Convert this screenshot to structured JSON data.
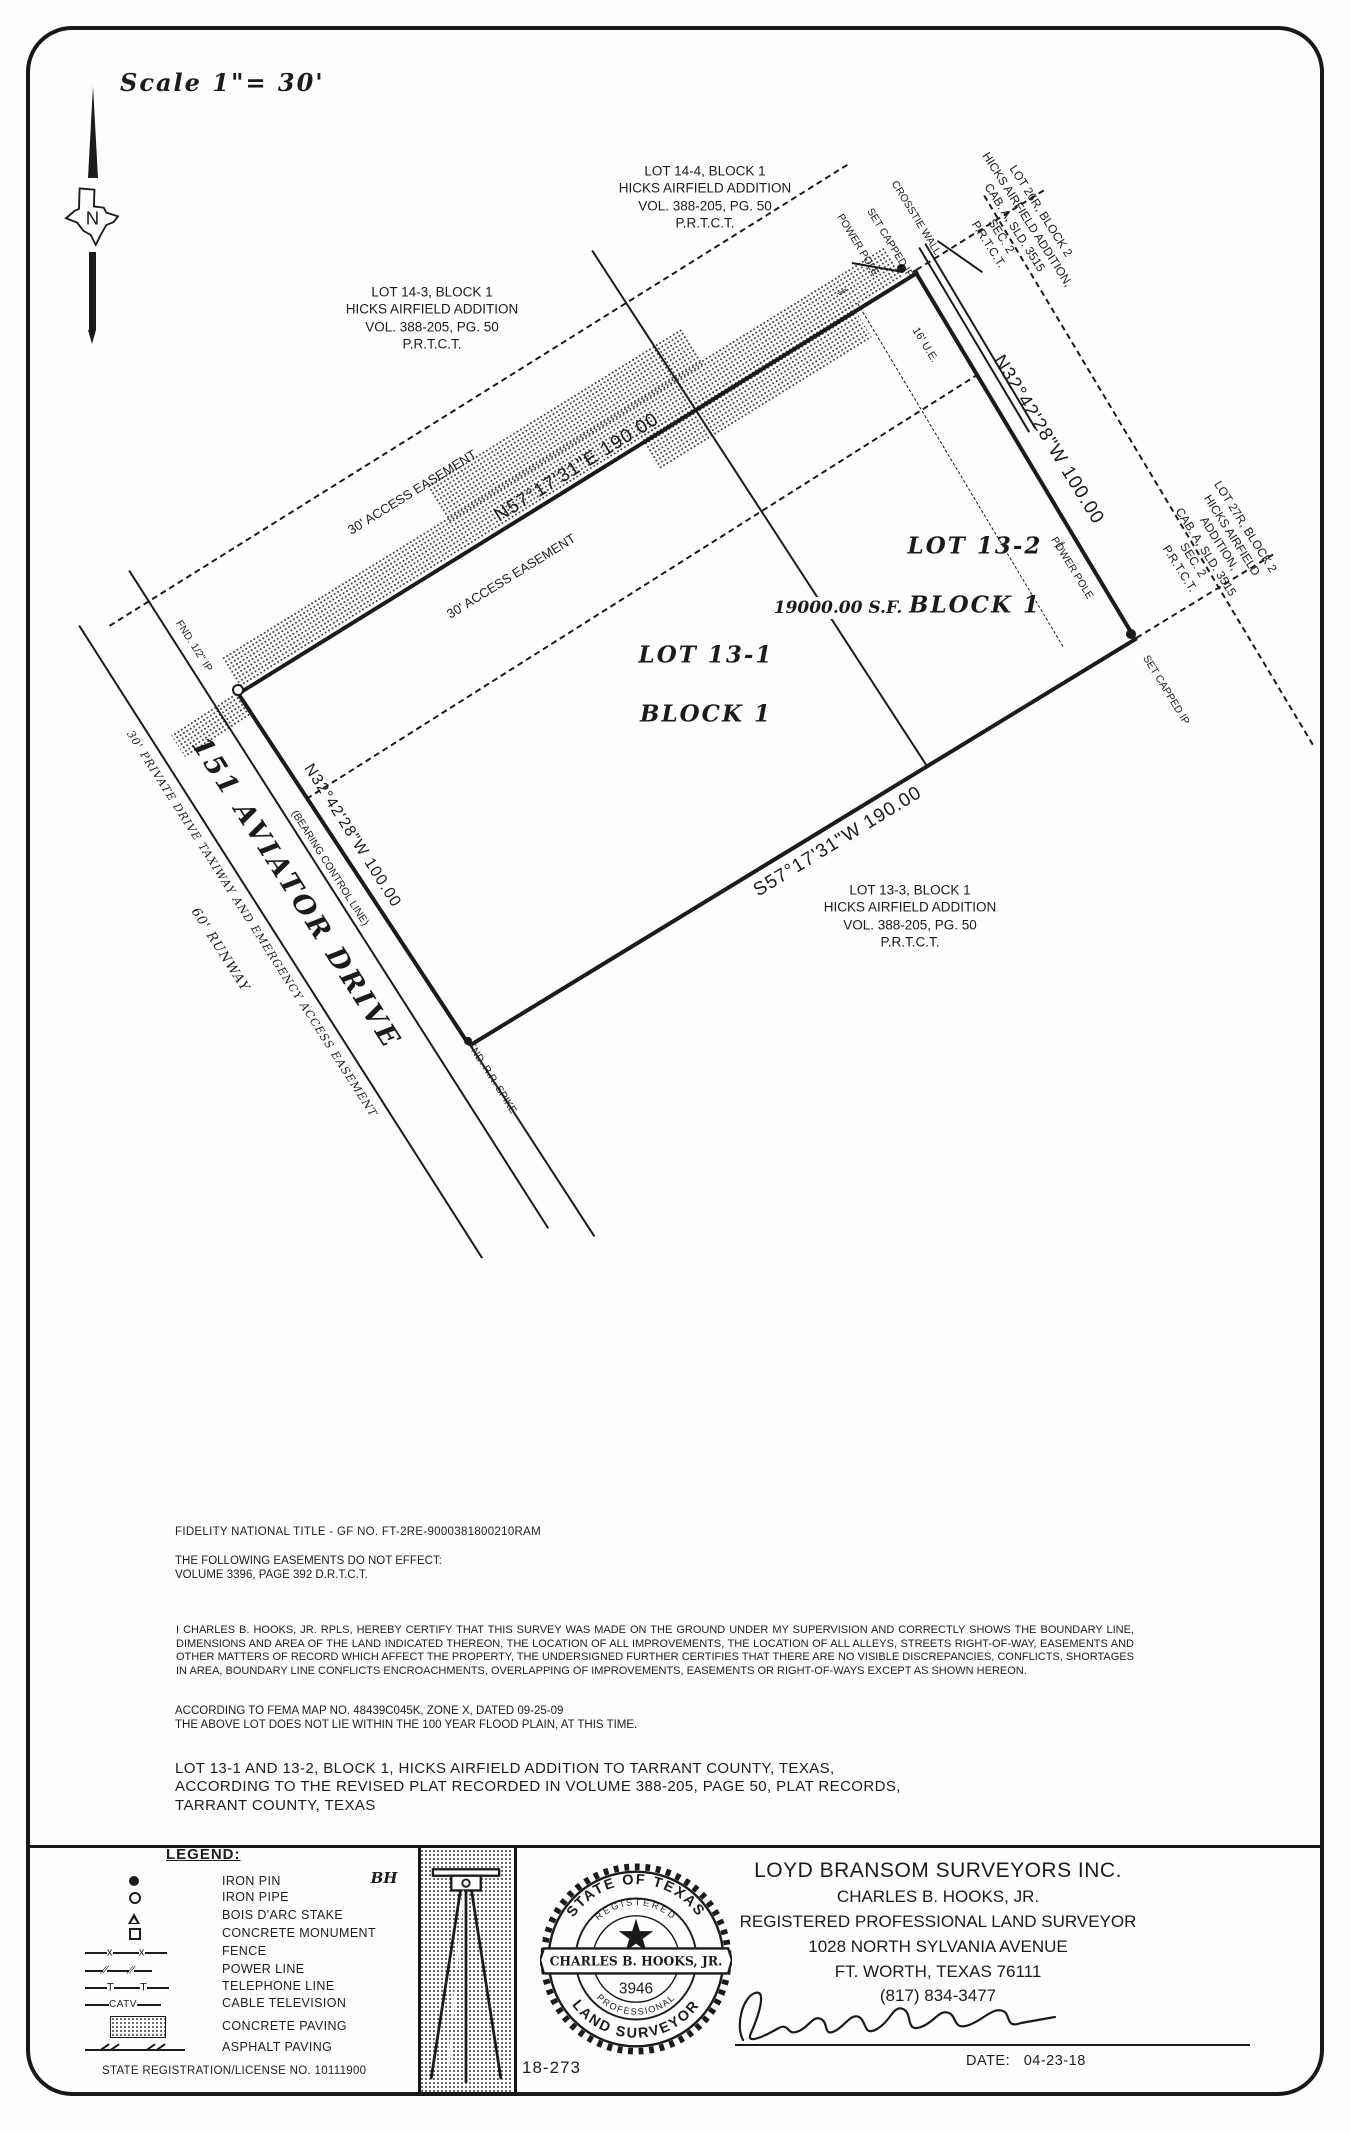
{
  "page": {
    "scale": "Scale 1\"= 30'",
    "north": "N"
  },
  "drawing": {
    "bearings": {
      "ne_top": "N57°17'31\"E  190.00",
      "ne_right": "N32°42'28\"W  100.00",
      "sw_bottom": "S57°17'31\"W  190.00",
      "west": "N32°42'28\"W  100.00",
      "west_note": "(BEARING CONTROL LINE)"
    },
    "street": {
      "name": "151 AVIATOR DRIVE",
      "easement": "30' PRIVATE DRIVE TAXIWAY AND EMERGENCY ACCESS EASEMENT",
      "runway": "60' RUNWAY"
    },
    "lots": {
      "lot1_line1": "LOT 13-1",
      "lot1_line2": "BLOCK 1",
      "lot2_line1": "LOT 13-2",
      "lot2_line2": "BLOCK 1",
      "area": "19000.00 S.F."
    },
    "easements": {
      "access_upper": "30'  ACCESS  EASEMENT",
      "access_lower": "30'  ACCESS  EASEMENT",
      "ue": "16' U.E."
    },
    "adjoiners": {
      "lot14_4": "LOT 14-4, BLOCK 1\nHICKS AIRFIELD ADDITION\nVOL. 388-205, PG. 50\nP.R.T.C.T.",
      "lot14_3": "LOT 14-3, BLOCK 1\nHICKS AIRFIELD ADDITION\nVOL. 388-205, PG. 50\nP.R.T.C.T.",
      "lot13_3": "LOT 13-3, BLOCK 1\nHICKS AIRFIELD ADDITION\nVOL. 388-205, PG. 50\nP.R.T.C.T.",
      "lot26r": "LOT 26R, BLOCK 2\nHICKS AIRFIELD ADDITION,\nCAB. A, SLD. 3515\nSEC. 2\nP.R.T.C.T.",
      "lot27r": "LOT 27R, BLOCK 2\nHICKS AIRFIELD ADDITION,\nCAB. A, SLD. 3515\nSEC. 2\nP.R.T.C.T."
    },
    "points": {
      "set_capped_ip_top": "SET CAPPED IP",
      "set_capped_ip_right": "SET CAPPED IP",
      "power_pole_top": "POWER POLE",
      "power_pole_right": "POWER POLE",
      "crosstie_wall": "CROSSTIE WALL",
      "fnd_ip": "FND. 1/2\" IP",
      "fnd_rr_spike": "FND. R.R. SPIKE",
      "power_mark": "∕∕"
    }
  },
  "notes": {
    "title_company": "FIDELITY NATIONAL TITLE  -  GF NO. FT-2RE-9000381800210RAM",
    "easements_note": "THE FOLLOWING EASEMENTS DO NOT EFFECT:\nVOLUME 3396, PAGE 392 D.R.T.C.T.",
    "certification": "I CHARLES B. HOOKS, JR. RPLS, HEREBY CERTIFY THAT THIS SURVEY WAS MADE ON THE GROUND UNDER MY SUPERVISION AND CORRECTLY SHOWS THE BOUNDARY LINE, DIMENSIONS AND AREA OF THE LAND INDICATED THEREON, THE LOCATION OF ALL IMPROVEMENTS, THE LOCATION OF ALL ALLEYS, STREETS RIGHT-OF-WAY, EASEMENTS AND OTHER MATTERS OF RECORD WHICH AFFECT THE PROPERTY, THE UNDERSIGNED FURTHER CERTIFIES THAT THERE ARE NO VISIBLE DISCREPANCIES, CONFLICTS, SHORTAGES IN AREA, BOUNDARY LINE CONFLICTS ENCROACHMENTS, OVERLAPPING OF IMPROVEMENTS, EASEMENTS OR RIGHT-OF-WAYS EXCEPT AS SHOWN HEREON.",
    "fema": "ACCORDING TO FEMA MAP NO. 48439C045K, ZONE X, DATED 09-25-09\nTHE ABOVE LOT DOES NOT LIE WITHIN THE 100 YEAR FLOOD PLAIN, AT THIS TIME.",
    "description": "LOT 13-1 AND 13-2, BLOCK 1, HICKS AIRFIELD ADDITION TO TARRANT COUNTY, TEXAS,\nACCORDING TO THE REVISED PLAT RECORDED IN VOLUME 388-205, PAGE 50, PLAT RECORDS,\nTARRANT COUNTY, TEXAS"
  },
  "legend": {
    "title": "LEGEND:",
    "bh": "BH",
    "items": [
      {
        "label": "IRON PIN",
        "symbol": "filled-circle"
      },
      {
        "label": "IRON PIPE",
        "symbol": "open-circle"
      },
      {
        "label": "BOIS D'ARC STAKE",
        "symbol": "open-triangle"
      },
      {
        "label": "CONCRETE MONUMENT",
        "symbol": "open-square"
      },
      {
        "label": "FENCE",
        "symbol": "fence-line"
      },
      {
        "label": "POWER LINE",
        "symbol": "power-line"
      },
      {
        "label": "TELEPHONE LINE",
        "symbol": "telephone-line"
      },
      {
        "label": "CABLE TELEVISION",
        "symbol": "catv-line"
      },
      {
        "label": "CONCRETE PAVING",
        "symbol": "stipple-swatch"
      },
      {
        "label": "ASPHALT PAVING",
        "symbol": "asphalt-swatch"
      }
    ],
    "marks": {
      "fence": "x",
      "power": "∕∕",
      "telephone": "T",
      "catv": "CATV"
    },
    "registration": "STATE REGISTRATION/LICENSE NO. 10111900"
  },
  "titleblock": {
    "company": "LOYD  BRANSOM  SURVEYORS  INC.",
    "surveyor": "CHARLES  B.  HOOKS,  JR.",
    "role": "REGISTERED  PROFESSIONAL  LAND  SURVEYOR",
    "address": "1028  NORTH  SYLVANIA  AVENUE",
    "city": "FT.  WORTH,  TEXAS    76111",
    "phone": "(817)  834-3477",
    "job_number": "18-273",
    "date_label": "DATE:",
    "date": "04-23-18",
    "seal": {
      "top": "STATE OF TEXAS",
      "registered": "REGISTERED",
      "name": "CHARLES B. HOOKS, JR.",
      "number": "3946",
      "professional": "PROFESSIONAL",
      "bottom": "LAND SURVEYOR"
    }
  }
}
